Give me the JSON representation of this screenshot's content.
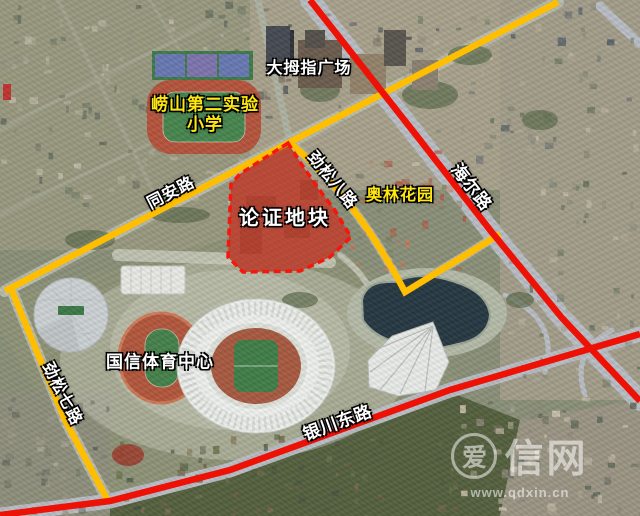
{
  "plot": {
    "label": "论证地块",
    "fill_color": "#d3241a",
    "border_color": "#f5170c",
    "border_style": "dashed"
  },
  "roads": {
    "tongan": {
      "label": "同安路",
      "line_color": "#ffbe00"
    },
    "jinsong7": {
      "label": "劲松七路",
      "line_color": "#ffbe00"
    },
    "jinsong8": {
      "label": "劲松八路",
      "line_color": "#ffbe00"
    },
    "haier": {
      "label": "海尔路",
      "line_color": "#ee1106"
    },
    "yinchuan": {
      "label": "银川东路",
      "line_color": "#ee1106"
    }
  },
  "places": {
    "damuzhi": {
      "label": "大拇指广场",
      "text_color": "#ffffff"
    },
    "school": {
      "label": "崂山第二实验小学",
      "line1": "崂山第二实验",
      "line2": "小学",
      "text_color": "#ffe810"
    },
    "aolin": {
      "label": "奥林花园",
      "text_color": "#ffe810"
    },
    "guoxin": {
      "label": "国信体育中心",
      "text_color": "#ffffff"
    }
  },
  "watermark": {
    "logo": "爱",
    "name": "信网",
    "url": "www.qdxin.cn",
    "color": "rgba(255,255,255,0.55)"
  }
}
